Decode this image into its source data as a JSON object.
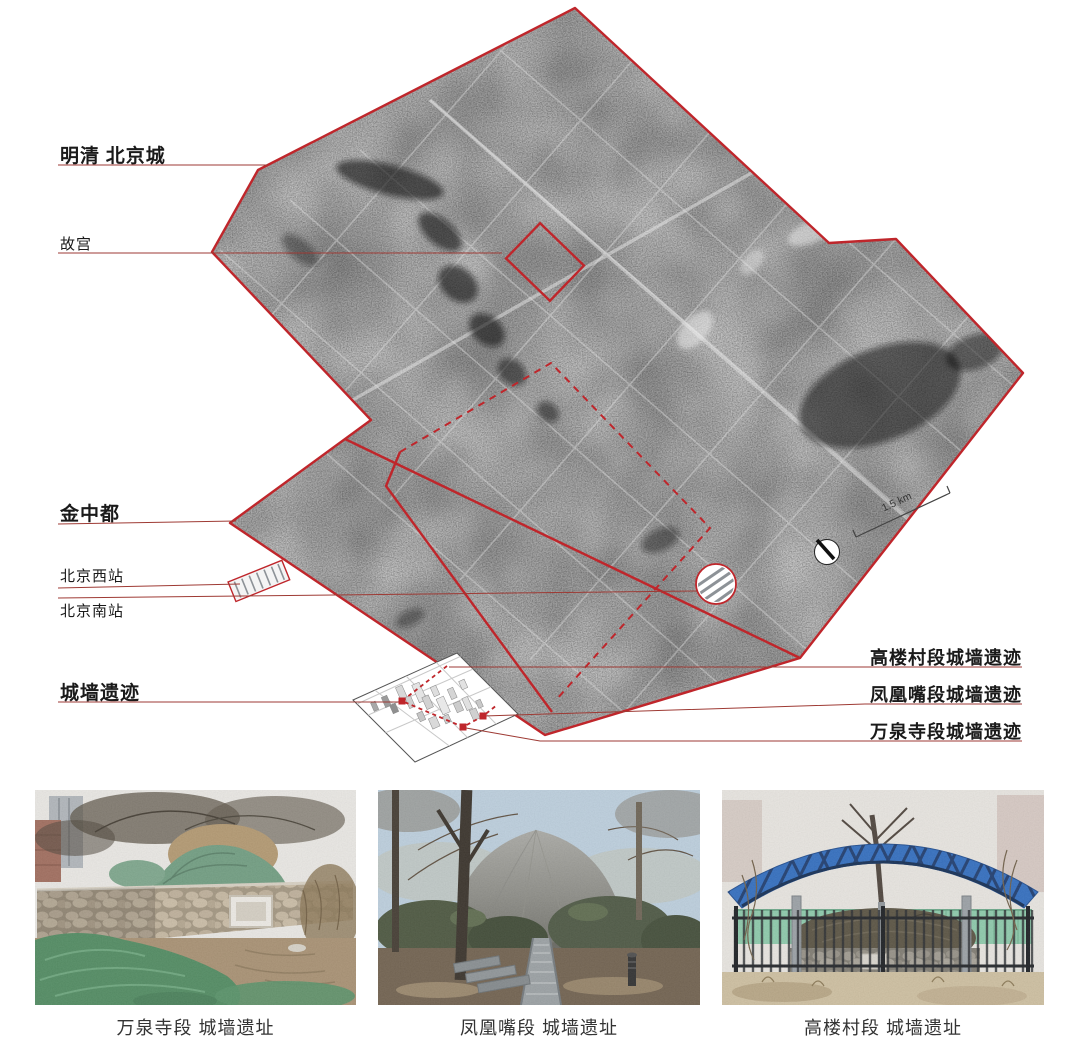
{
  "figure": {
    "map": {
      "left_labels": [
        {
          "text": "明清 北京城"
        },
        {
          "text": "故宫"
        },
        {
          "text": "金中都"
        },
        {
          "text": "北京西站"
        },
        {
          "text": "北京南站"
        },
        {
          "text": "城墙遗迹"
        }
      ],
      "right_labels": [
        {
          "text": "高楼村段城墙遗迹"
        },
        {
          "text": "凤凰嘴段城墙遗迹"
        },
        {
          "text": "万泉寺段城墙遗迹"
        }
      ],
      "scale_label": "1.5 km",
      "icons": {
        "compass": "north-arrow-icon",
        "scale": "scale-bar"
      }
    },
    "photos": [
      {
        "caption": "万泉寺段 城墙遗址"
      },
      {
        "caption": "凤凰嘴段 城墙遗址"
      },
      {
        "caption": "高楼村段 城墙遗址"
      }
    ],
    "colors": {
      "boundary_red": "#bf262b",
      "leader_red": "#9e3a34",
      "canopy_blue": "#2e6cc0",
      "tarp_green": "#4e8a5f"
    }
  }
}
